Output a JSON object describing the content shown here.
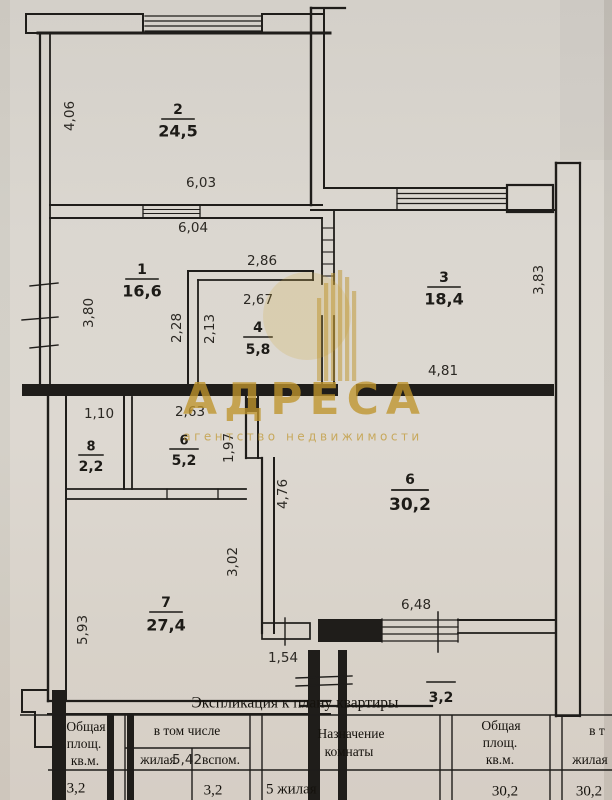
{
  "plan": {
    "rooms": {
      "r2": {
        "num": "2",
        "area": "24,5"
      },
      "r1": {
        "num": "1",
        "area": "16,6"
      },
      "r3": {
        "num": "3",
        "area": "18,4"
      },
      "r4": {
        "num": "4",
        "area": "5,8"
      },
      "r8": {
        "num": "8",
        "area": "2,2"
      },
      "r6s": {
        "num": "6",
        "area": "5,2"
      },
      "r6b": {
        "num": "6",
        "area": "30,2"
      },
      "r7": {
        "num": "7",
        "area": "27,4"
      },
      "balcony": {
        "num": "",
        "area": "3,2"
      }
    },
    "dimensions": {
      "d_4_06": "4,06",
      "d_6_03": "6,03",
      "d_6_04": "6,04",
      "d_2_86": "2,86",
      "d_2_67": "2,67",
      "d_3_80": "3,80",
      "d_2_28": "2,28",
      "d_2_13": "2,13",
      "d_3_83": "3,83",
      "d_4_81": "4,81",
      "d_1_10": "1,10",
      "d_2_63": "2,63",
      "d_1_97": "1,97",
      "d_4_76": "4,76",
      "d_3_02": "3,02",
      "d_5_93": "5,93",
      "d_6_48": "6,48",
      "d_1_54": "1,54",
      "d_5_42": "5,42"
    }
  },
  "watermark": {
    "name": "АДРЕСА",
    "tagline": "агентство недвижимости",
    "color": "#bf952c"
  },
  "table": {
    "title": "Экспликация к плану квартиры",
    "col_total": {
      "l1": "Общая",
      "l2": "площ.",
      "l3": "кв.м."
    },
    "col_including": "в том числе",
    "sub_living": "жилая",
    "sub_aux": "вспом.",
    "col_purpose": {
      "l1": "Назначение",
      "l2": "комнаты"
    },
    "col_total2": {
      "l1": "Общая",
      "l2": "площ.",
      "l3": "кв.м."
    },
    "col_including2": "в т",
    "sub_living2": "жилая",
    "row": {
      "total": "3,2",
      "aux": "3,2",
      "purpose": "5 жилая",
      "total2": "30,2",
      "living2": "30,2"
    }
  }
}
